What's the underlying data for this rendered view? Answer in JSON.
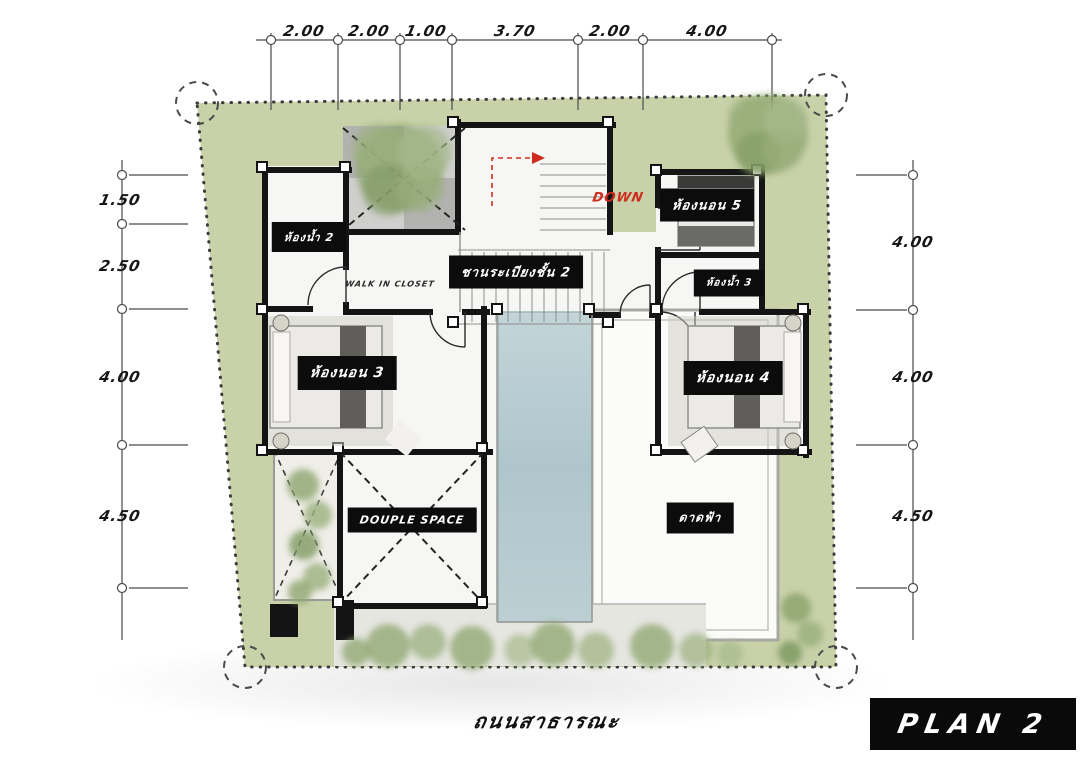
{
  "plan_badge": {
    "label": "PLAN 2"
  },
  "road_label": "ถนนสาธารณะ",
  "stair": {
    "down_label": "DOWN"
  },
  "rooms": {
    "bathroom_2": "ห้องน้ำ 2",
    "walk_in_closet": "WALK IN CLOSET",
    "balcony_2f": "ชานระเบียงชั้น 2",
    "bedroom_5": "ห้องนอน 5",
    "bathroom_3": "ห้องน้ำ 3",
    "bedroom_3": "ห้องนอน 3",
    "bedroom_4": "ห้องนอน 4",
    "double_space": "DOUPLE SPACE",
    "roof_deck": "ดาดฟ้า"
  },
  "dimensions": {
    "top": [
      "2.00",
      "2.00",
      "1.00",
      "3.70",
      "2.00",
      "4.00"
    ],
    "left": [
      "1.50",
      "2.50",
      "4.00",
      "4.50"
    ],
    "right": [
      "4.00",
      "4.00",
      "4.50"
    ]
  },
  "colors": {
    "site_green": "#c8d1a8",
    "pool_blue": "#b5cbd1",
    "wall": "#141414",
    "label_bg": "#0c0c0c",
    "label_text": "#ffffff",
    "down_red": "#cf2b1e",
    "tree_green": "#8da56e"
  }
}
